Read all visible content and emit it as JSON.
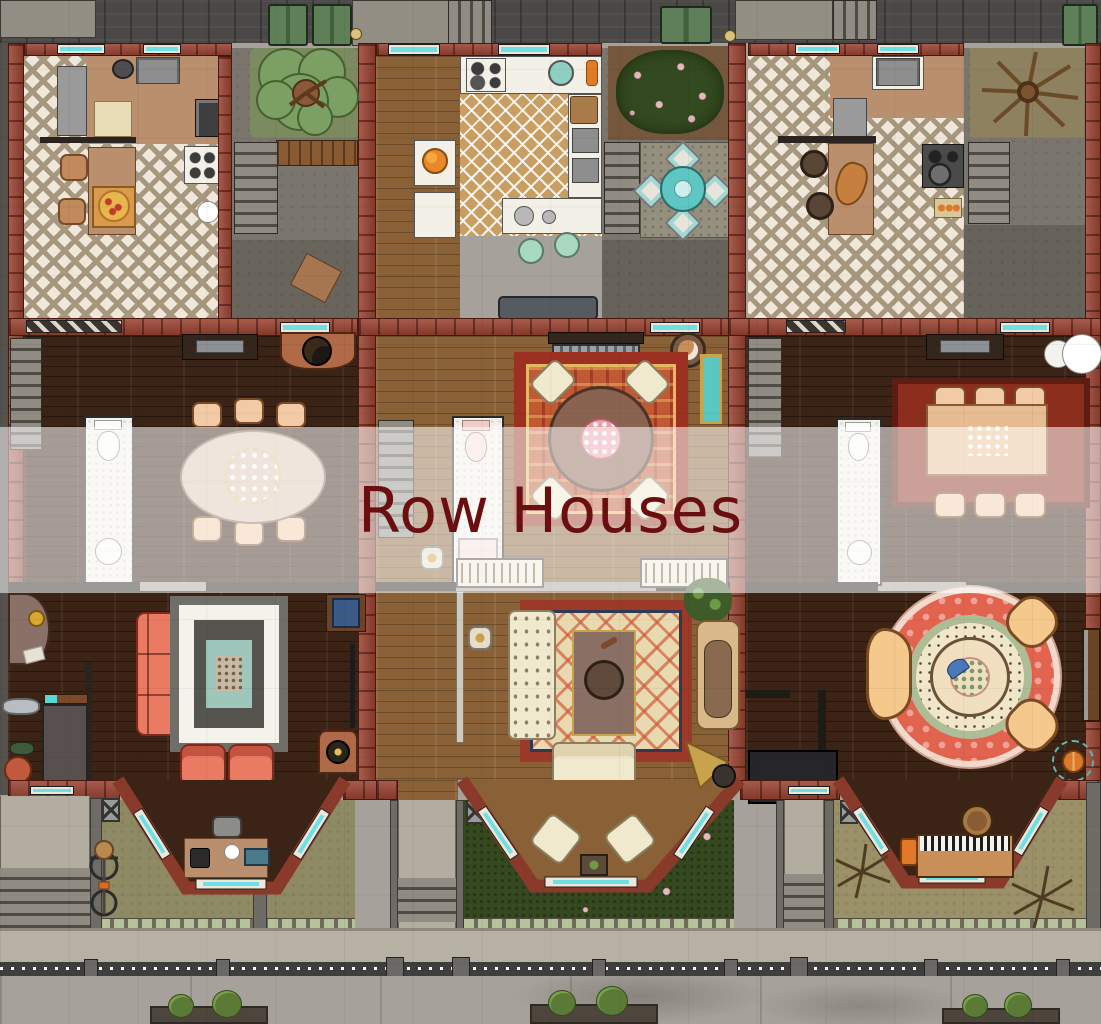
{
  "title": {
    "text": "Row Houses"
  },
  "overlay": {
    "background": "rgba(255,255,255,0.55)",
    "text_color": "#6a0e10"
  },
  "palette": {
    "brick": "#9a4433",
    "wood_dark": "#3b2316",
    "wood_light": "#8a6136",
    "tile_cream": "#efe8da",
    "tile_tan": "#c99e63",
    "concrete": "#7b766d",
    "street": "#a6a19a",
    "sidewalk": "#b7b1a4",
    "grass_olive": "#8e8a64",
    "bush_green": "#35491f",
    "window_glass": "#6fdfe4",
    "sofa_coral": "#ea7a61",
    "sofa_cream": "#f1e9ce",
    "rug_red": "#9c3021",
    "teal_accent": "#5ec7c4"
  },
  "houses": [
    {
      "name": "left-house",
      "rooms": [
        "kitchen",
        "back-yard",
        "dining-room",
        "bathroom",
        "living-room",
        "bay-window-study",
        "front-yard"
      ],
      "furniture": [
        "refrigerator",
        "double-sink",
        "stove",
        "kitchen-table-with-pizza",
        "backyard-tree",
        "basement-stairs",
        "oval-dining-table",
        "six-dining-chairs",
        "toilet",
        "wash-basin",
        "coral-sofa",
        "coral-armchairs",
        "geometric-rug",
        "fireplace",
        "writing-desk",
        "typewriter",
        "bicycle",
        "green-dumpsters"
      ]
    },
    {
      "name": "middle-house",
      "rooms": [
        "hallway",
        "kitchen",
        "back-patio",
        "dining-room",
        "bathroom",
        "living-room",
        "bay-window-nook",
        "front-garden"
      ],
      "furniture": [
        "stove",
        "double-sink",
        "mint-stools",
        "fruit-bowl",
        "patio-table-set",
        "flowering-bush",
        "radiator",
        "cat-basket",
        "round-dining-table",
        "cream-dining-chairs",
        "ornate-red-rug",
        "pink-toilet",
        "shower",
        "tufted-cream-sofa",
        "loveseat",
        "chaise-lounge",
        "potted-plant",
        "gramophone",
        "bookshelves",
        "bay-cushion-chairs"
      ]
    },
    {
      "name": "right-house",
      "rooms": [
        "kitchen",
        "back-yard",
        "dining-room",
        "bathroom",
        "living-room",
        "bay-window-music-room",
        "front-yard"
      ],
      "furniture": [
        "double-sink",
        "refrigerator",
        "kitchen-peninsula",
        "wooden-stools",
        "stove",
        "dead-tree",
        "rectangular-dining-table",
        "six-dining-chairs",
        "stacked-plates",
        "toilet",
        "wash-basin",
        "round-mandala-rug",
        "wedge-armchairs",
        "round-center-table",
        "television",
        "upright-piano",
        "piano-stool",
        "dry-branches",
        "orange-ball"
      ]
    }
  ],
  "street": {
    "features": [
      "sidewalk",
      "iron-fence",
      "fence-gate-posts",
      "roadway",
      "expansion-seams",
      "flower-planters",
      "tree-shadows",
      "front-steps"
    ]
  },
  "alley": {
    "features": [
      "dark-brick-paving",
      "concrete-pads",
      "green-dumpsters",
      "basement-stairs",
      "bollard-lamps"
    ]
  }
}
